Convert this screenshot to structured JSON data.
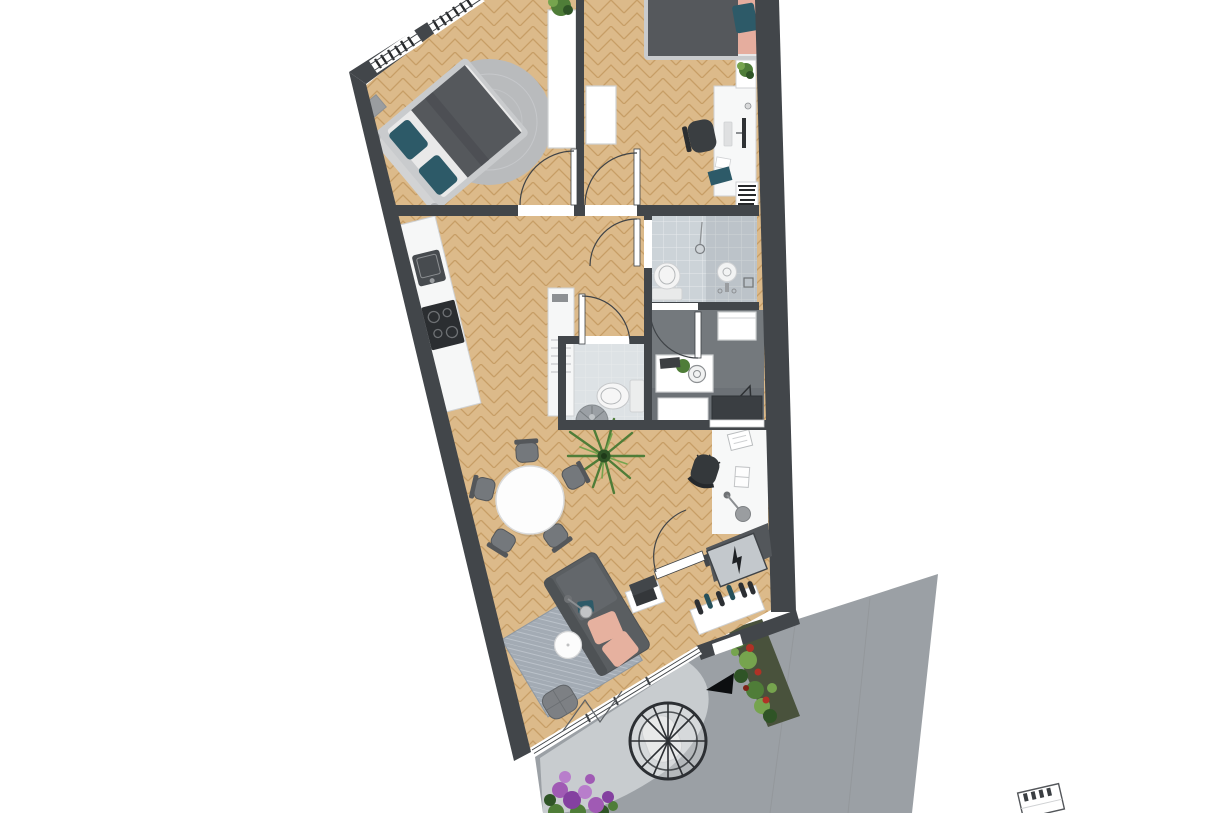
{
  "canvas": {
    "width": 1220,
    "height": 813
  },
  "scene": {
    "kind": "apartment floor plan, rendered top-down view",
    "rooms": [
      "bedroom-1",
      "bedroom-2",
      "bathroom",
      "wc",
      "utility-room",
      "kitchen",
      "corridor",
      "living-dining-room",
      "desk-nook",
      "entrance-vestibule",
      "balcony"
    ],
    "no_visible_text": true
  },
  "icons": {
    "lightning_bolt": "⚡",
    "direction_arrow": "◄",
    "stairs_fragment": "neighboring-stairs-box"
  },
  "colors": {
    "wall": "#42464a",
    "white": "#ffffff",
    "wood_base": "#dcba8a",
    "wood_line": "#c79e66",
    "tile_bath": "#ccd3d8",
    "tile_line": "#e6eaec",
    "tile_wc": "#dde2e5",
    "tile_shadow": "#8d959c",
    "utility_floor": "#74797d",
    "utility_shade": "#686d72",
    "counter": "#f6f7f7",
    "appliance_dark": "#474b4f",
    "cooktop": "#2b2e31",
    "rug_round": "#b9bbbd",
    "rug_living": "#a3abb4",
    "rug_pattern": "#c3cad2",
    "sofa_dark": "#5a5e61",
    "sofa_back": "#4e5255",
    "sofa_seat": "#63676b",
    "cushion_salmon": "#e6b19f",
    "sheet_salmon": "#e5ad9e",
    "pillow_teal": "#2d5a68",
    "bed_blanket": "#55585c",
    "bed_frame": "#c9cbcd",
    "mattress": "#e9e9e9",
    "chair_gray": "#74787c",
    "chair_dark": "#54575a",
    "office_chair": "#34383b",
    "desk_white": "#f7f8f8",
    "plant_green": "#4f7d38",
    "plant_light": "#76a44e",
    "plant_dark": "#2f5426",
    "flower_red": "#b03226",
    "flower_red_dark": "#7e2317",
    "flower_purple": "#a05ab4",
    "flower_purple_dark": "#8440a0",
    "flower_purple_light": "#b87ecb",
    "paving": "#9ba0a5",
    "patio": "#c8cccf",
    "planter_base": "#49523c",
    "egg_frame": "#2c2f33",
    "egg_cushion": "#e8e9e9",
    "arrow_black": "#0c0e10",
    "panel_gray": "#c3c8cc",
    "vest_dark": "#53575b",
    "shoe_dark": "#2c2f33",
    "shoe_teal": "#26505a",
    "line_dark": "#3f4347",
    "light_gray": "#cfd1d3",
    "metal_gray": "#9a9da0",
    "mid_gray": "#8d9093",
    "monitor_dark": "#2f3235",
    "cabinet_dark": "#3a3e42",
    "slat_dark": "#26282a"
  }
}
